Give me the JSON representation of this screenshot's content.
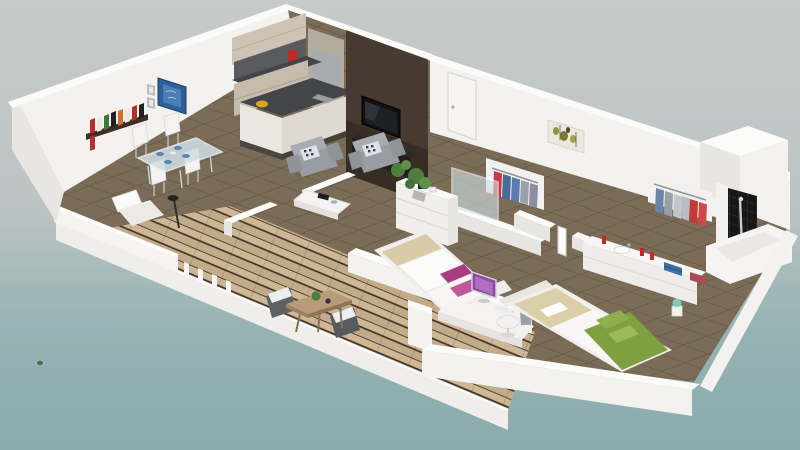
{
  "meta": {
    "kind": "3d-apartment-floor-plan-render",
    "view": "isometric-cutaway",
    "canvas": {
      "width": 800,
      "height": 450
    }
  },
  "palette": {
    "bg_top": "#c6cac9",
    "bg_mid": "#bdc4c3",
    "bg_teal": "#97b3b4",
    "bg_bottom": "#8aabad",
    "wall_top": "#fbfbfa",
    "wall_face": "#f3f2ef",
    "wall_shade": "#e8e6e2",
    "floor_tile": "#7b6c58",
    "grout": "#5e5142",
    "deck_plank_a": "#cdb795",
    "deck_plank_b": "#c1ab89",
    "deck_gap": "#42332a",
    "accent_wall": "#483a30",
    "tv_black": "#101114",
    "counter_dark": "#434548",
    "cabinet_beige": "#cdc4b6",
    "sofa_gray": "#989ca3",
    "pillow_dark": "#3a3f55",
    "bed1_pillow": "#a93d80",
    "bed1_pillow_light": "#c2589b",
    "bed1_blanket": "#d7cba8",
    "bed2_green": "#7fa040",
    "bed2_pillow": "#8fae4e",
    "bed2_beige": "#dbcfaa",
    "towel_blue": "#3e6fa3",
    "towel_red": "#ad4a5a",
    "red_accessory": "#c62828",
    "glass": "#cfe0e4",
    "plant_green": "#4e7e3e",
    "shower_tile": "#161616",
    "chrome": "#c9ccce",
    "art_blue": "#2e5e97",
    "art_olive": "#97923f",
    "wood_table": "#ba9b79",
    "book_red": "#b03030",
    "book_green": "#3a7a3a",
    "book_orange": "#d07030",
    "lamp_teal": "#7fd4c8"
  },
  "rooms": [
    {
      "name": "kitchen",
      "furniture": [
        "l-shaped-cabinets",
        "upper-cabinets-with-lights",
        "dark-countertop",
        "island-counter",
        "fridge-column",
        "red-coffee-maker",
        "yellow-fruit-bowl",
        "sink"
      ]
    },
    {
      "name": "living-room",
      "furniture": [
        "dark-accent-wall",
        "flat-tv",
        "black-media-cabinet",
        "gray-armchair",
        "gray-armchair",
        "patterned-pillows",
        "white-coffee-table",
        "potted-plant",
        "white-lounge-chair",
        "floor-lamp"
      ]
    },
    {
      "name": "dining-area",
      "furniture": [
        "glass-dining-table",
        "white-dining-chair",
        "white-dining-chair",
        "white-dining-chair",
        "white-dining-chair",
        "wall-bookshelf",
        "blue-wall-art"
      ]
    },
    {
      "name": "terrace",
      "furniture": [
        "wood-plank-deck",
        "white-railing",
        "railing-posts",
        "wood-outdoor-table",
        "wicker-chair",
        "wicker-chair",
        "table-plant"
      ]
    },
    {
      "name": "bedroom-1",
      "furniture": [
        "double-bed",
        "beige-blanket",
        "magenta-pillows",
        "white-headboard",
        "desk",
        "desktop-computer",
        "white-swivel-chair",
        "laundry-basket",
        "white-dresser",
        "plant"
      ]
    },
    {
      "name": "walk-in-closet",
      "furniture": [
        "glass-partition",
        "hanging-clothes-red-blue"
      ]
    },
    {
      "name": "bathroom",
      "furniture": [
        "white-vanity",
        "sink",
        "red-soap-bottles",
        "blue-towels",
        "red-towels",
        "bathtub",
        "open-door"
      ]
    },
    {
      "name": "shower-room",
      "furniture": [
        "black-tiled-shower",
        "chrome-shower-column",
        "hanging-clothes-rack"
      ]
    },
    {
      "name": "bedroom-2",
      "furniture": [
        "double-bed",
        "beige-duvet",
        "green-blanket",
        "green-pillows",
        "teal-bedside-lamp"
      ]
    },
    {
      "name": "hallway",
      "furniture": [
        "entry-door",
        "green-abstract-painting"
      ]
    }
  ]
}
